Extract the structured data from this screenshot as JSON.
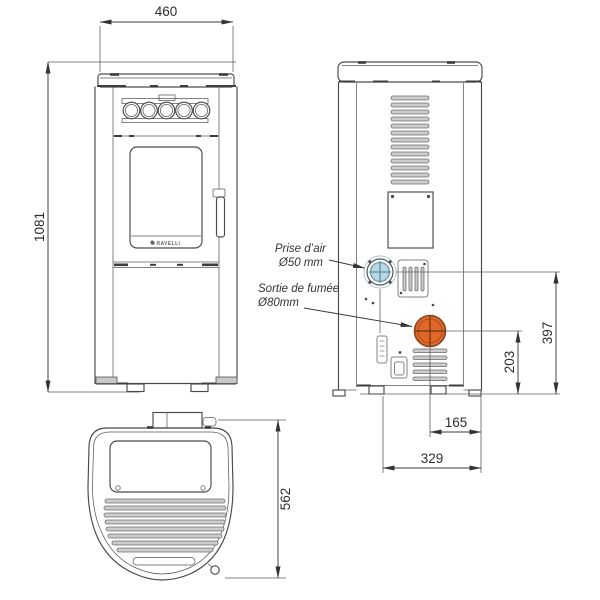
{
  "brand": {
    "logo_text": "RAVELLI"
  },
  "colors": {
    "line": "#4a4a4a",
    "air_intake_fill": "#b8d9e3",
    "air_intake_stroke": "#5d8fa3",
    "smoke_outlet_fill": "#e0662a",
    "smoke_outlet_stroke": "#8f4418",
    "slat_fill": "#cccccc"
  },
  "front_view": {
    "width_mm": "460",
    "height_mm": "1081"
  },
  "rear_view": {
    "air_intake_height_mm": "397",
    "smoke_outlet_height_mm": "203",
    "smoke_outlet_offset_mm": "165",
    "base_width_mm": "329",
    "air_intake_label": {
      "line1": "Prise d’air",
      "line2": "Ø50 mm"
    },
    "smoke_outlet_label": {
      "line1": "Sortie de fumée",
      "line2": "Ø80mm"
    }
  },
  "top_view": {
    "depth_mm": "562"
  }
}
